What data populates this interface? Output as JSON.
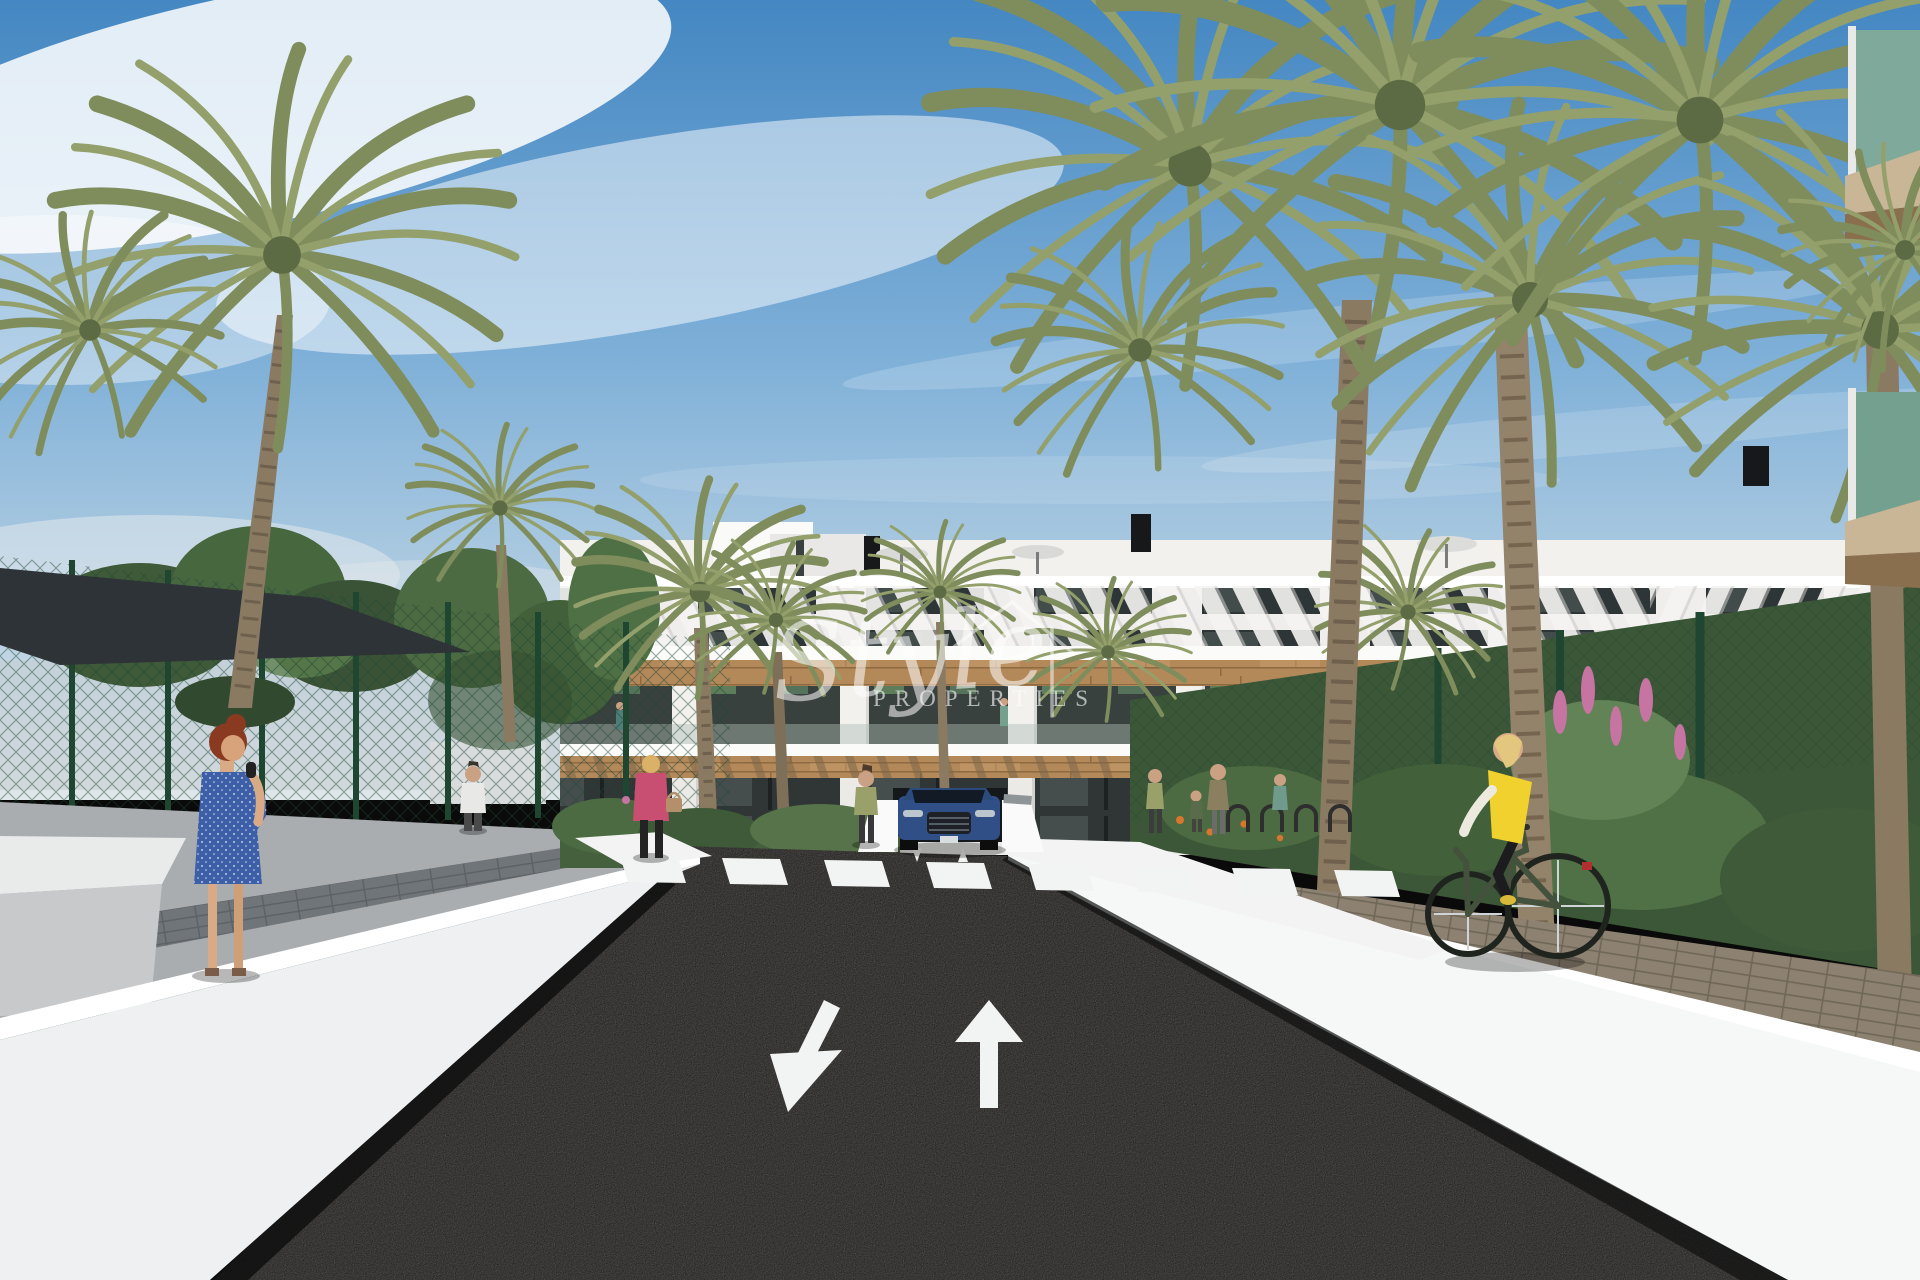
{
  "watermark": {
    "brand": "Style",
    "subtitle": "PROPERTIES",
    "icon": "house-outline-icon",
    "color": "#ffffff"
  },
  "road_markings": {
    "left_arrow_direction": "down-left",
    "right_arrow_direction": "up",
    "crosswalk_stripe_count": 8
  },
  "palette": {
    "sky_top": "#4487c2",
    "sky_mid": "#7fb0d8",
    "sky_horizon": "#dfe7ea",
    "cloud_white": "#ffffff",
    "building_white": "#f2f1ee",
    "slab_white": "#fbfbfa",
    "window_glass": "#2e3536",
    "wood_cladding": "#b4895a",
    "wood_dark": "#8f6b42",
    "asphalt": "#232120",
    "marking_white": "#f2f4f3",
    "sidewalk_gray": "#a9adb0",
    "paver_brown": "#8d8171",
    "wall_white": "#f0f1f1",
    "wall_lit": "#ffffff",
    "fence_green": "#235139",
    "canopy_dark": "#2e3338",
    "foliage_dark": "#3e5a39",
    "foliage_mid": "#4c6b42",
    "foliage_light": "#628355",
    "palm_frond": "#7f8d5c",
    "palm_frond_light": "#93a06b",
    "palm_trunk": "#8a7a62",
    "flower_orange": "#d7772e",
    "flower_pink": "#c674a2",
    "balcony_glass_green": "#7fa99b",
    "balcony_tan": "#c9b696",
    "balcony_tan_dark": "#8a6f4e",
    "car_blue": "#2f4f86",
    "car_blue_dark": "#223a63",
    "vest_yellow": "#f0d12e",
    "jacket_pink": "#c94f72",
    "dress_blue": "#3c5fa8",
    "skin": "#d8ab86"
  }
}
